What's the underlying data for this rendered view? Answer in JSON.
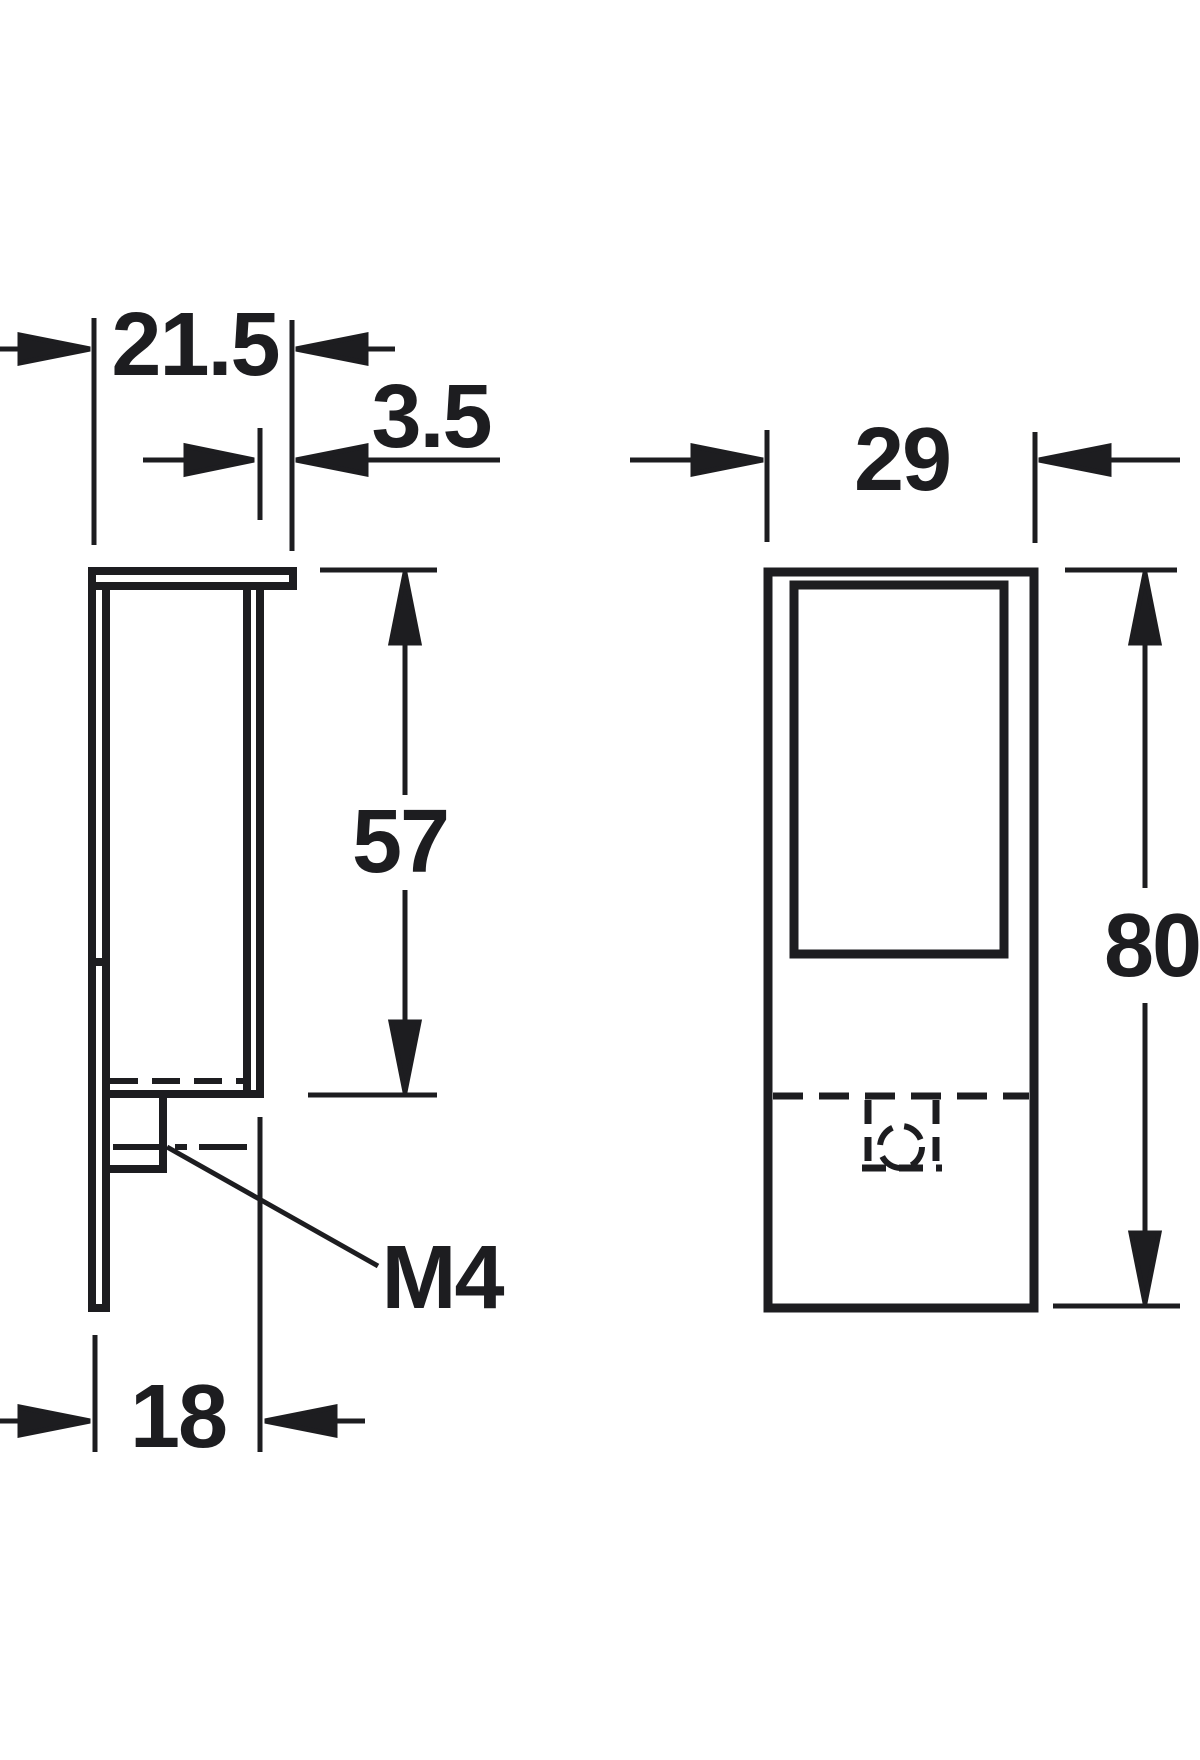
{
  "drawing": {
    "line_color": "#1d1d20",
    "background_color": "#ffffff",
    "side_view": {
      "overall_width": "21.5",
      "flange_overhang": "3.5",
      "channel_depth": "57",
      "thread": "M4",
      "body_depth": "18"
    },
    "front_view": {
      "width": "29",
      "height": "80"
    }
  }
}
